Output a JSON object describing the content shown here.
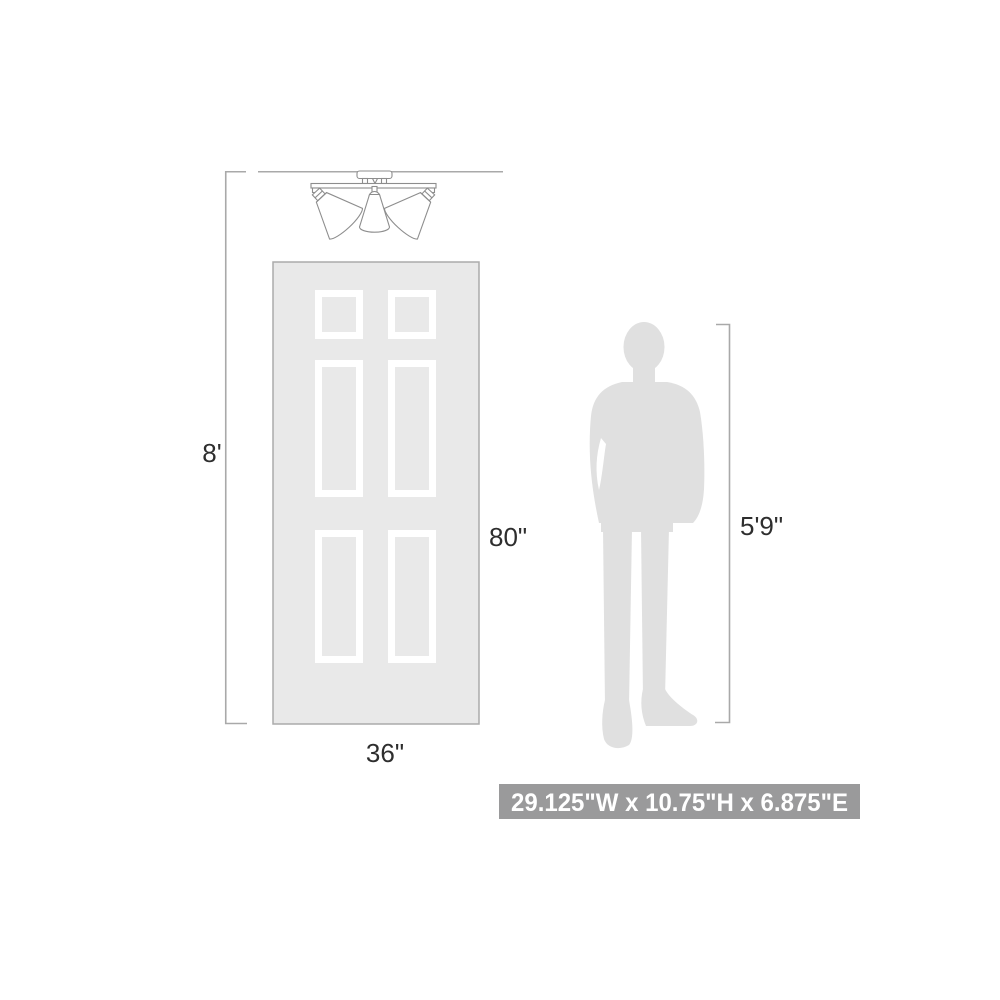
{
  "diagram_type": "product-scale-dimension-diagram",
  "product": "3-light semi-flush ceiling spotlight fixture",
  "colors": {
    "background": "#ffffff",
    "dimension_line": "#a9a9a9",
    "fixture_line": "#8d8d8d",
    "door_fill": "#e9e9e9",
    "door_border": "#ababab",
    "panel_frame": "#ffffff",
    "person_fill": "#e0e0e0",
    "label_text": "#2e2e2e",
    "spec_box_bg": "#9a9a9b",
    "spec_box_text": "#ffffff"
  },
  "labels": {
    "ceiling_height": "8'",
    "door_height": "80\"",
    "door_width": "36\"",
    "person_height": "5'9\"",
    "product_dimensions": "29.125\"W x 10.75\"H x 6.875\"E"
  },
  "reference_objects": {
    "door": "six-panel door, 36 inches wide by 80 inches tall",
    "person": "human silhouette, 5 feet 9 inches tall",
    "ceiling": "8 foot ceiling line"
  }
}
